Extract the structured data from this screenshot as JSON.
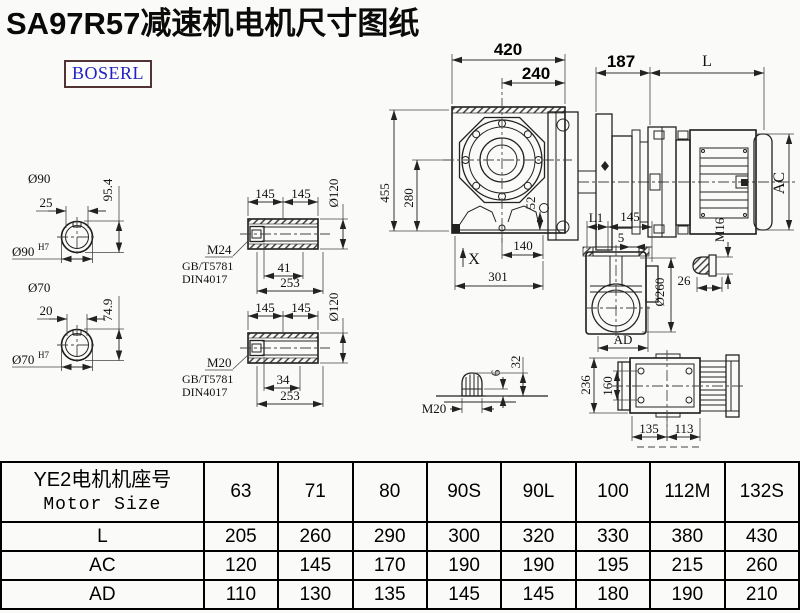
{
  "title": "SA97R57减速机电机尺寸图纸",
  "logo": "BOSERL",
  "views": {
    "front": {
      "d420": "420",
      "d240": "240",
      "d455": "455",
      "d280": "280",
      "d52": "52",
      "d140": "140",
      "d301": "301",
      "dx": "X"
    },
    "motor": {
      "d187": "187",
      "dl": "L",
      "dac": "AC"
    },
    "shaft90": {
      "dia": "Ø90",
      "d25": "25",
      "d954": "95.4",
      "dia_h7": "Ø90",
      "h7": "H7"
    },
    "shaft70": {
      "dia": "Ø70",
      "d20": "20",
      "d749": "74.9",
      "dia_h7": "Ø70",
      "h7": "H7"
    },
    "hollow1": {
      "d145a": "145",
      "d145b": "145",
      "dia120": "Ø120",
      "m": "M24",
      "gb": "GB/T5781",
      "din": "DIN4017",
      "d41": "41",
      "d253": "253"
    },
    "hollow2": {
      "d145a": "145",
      "d145b": "145",
      "dia120": "Ø120",
      "m": "M20",
      "gb": "GB/T5781",
      "din": "DIN4017",
      "d34": "34",
      "d253": "253"
    },
    "side": {
      "dl1": "L1",
      "d145": "145",
      "d5": "5",
      "dia260": "Ø260",
      "dad": "AD"
    },
    "plug16": {
      "m": "M16",
      "d26": "26"
    },
    "plug20": {
      "m": "M20",
      "d6": "6",
      "d32": "32"
    },
    "top": {
      "d236": "236",
      "d160": "160",
      "d135": "135",
      "d113": "113"
    }
  },
  "table": {
    "header_cn": "YE2电机机座号",
    "header_en": "Motor Size",
    "sizes": [
      "63",
      "71",
      "80",
      "90S",
      "90L",
      "100",
      "112M",
      "132S"
    ],
    "rows": [
      {
        "label": "L",
        "values": [
          "205",
          "260",
          "290",
          "300",
          "320",
          "330",
          "380",
          "430"
        ]
      },
      {
        "label": "AC",
        "values": [
          "120",
          "145",
          "170",
          "190",
          "190",
          "195",
          "215",
          "260"
        ]
      },
      {
        "label": "AD",
        "values": [
          "110",
          "130",
          "135",
          "145",
          "145",
          "180",
          "190",
          "210"
        ]
      }
    ]
  }
}
